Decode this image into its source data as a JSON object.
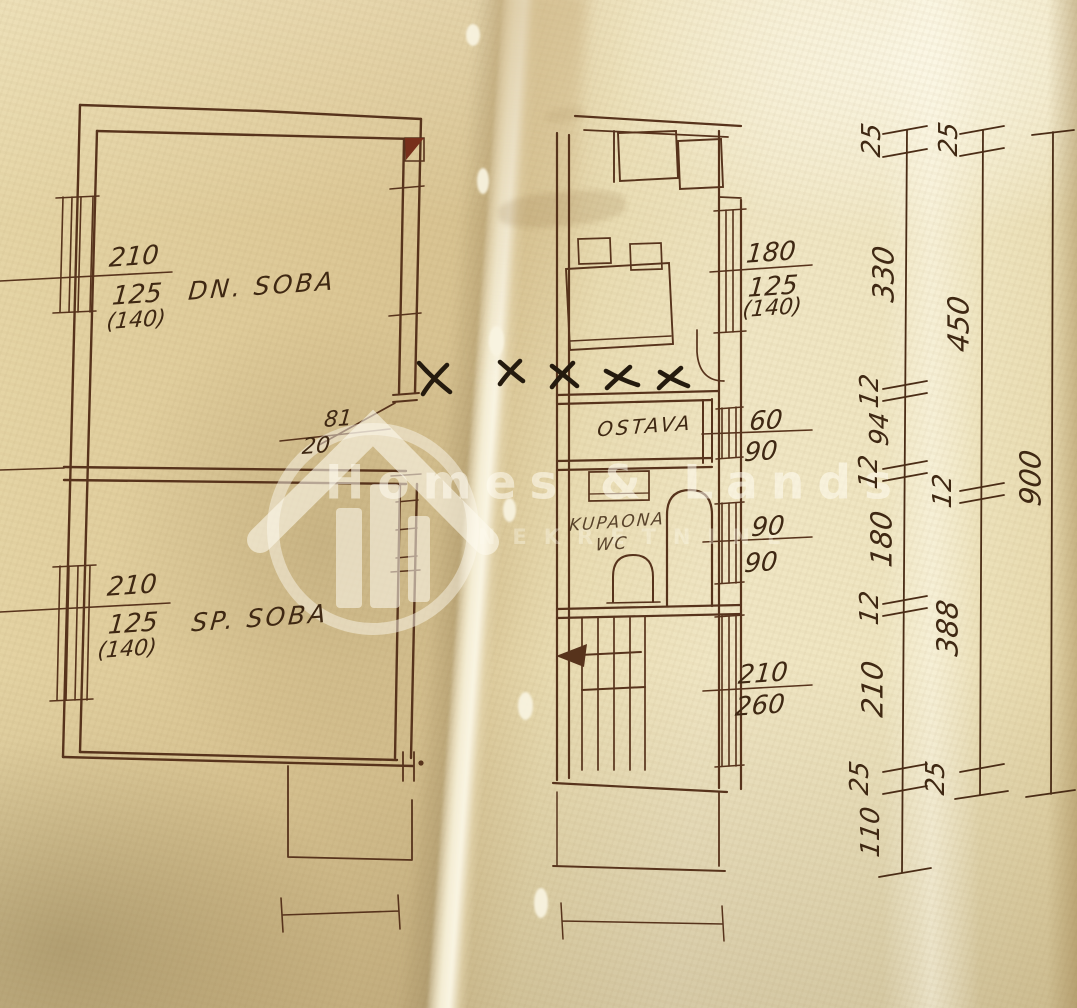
{
  "watermark": {
    "brand": "Homes & Lands",
    "tagline": "NEKRETNINE"
  },
  "rooms": {
    "living": "DN. SOBA",
    "bedroom": "SP. SOBA",
    "pantry": "OSTAVA",
    "bath_line1": "KUPAONA",
    "bath_line2": "WC"
  },
  "openings": {
    "living_window": {
      "w": "210",
      "h": "125",
      "alt": "(140)"
    },
    "bedroom_window": {
      "w": "210",
      "h": "125",
      "alt": "(140)"
    },
    "kitchen_window": {
      "w": "180",
      "h": "125",
      "alt": "(140)"
    },
    "living_door": {
      "w": "81",
      "h": "20"
    },
    "pantry_door": {
      "w": "60",
      "h": "90"
    },
    "bath_window": {
      "w": "90",
      "h": "90"
    },
    "stair_window": {
      "w": "210",
      "h": "260"
    }
  },
  "dimension_chains": {
    "inner": [
      "25",
      "330",
      "12",
      "94",
      "12",
      "180",
      "12",
      "210",
      "25",
      "110"
    ],
    "middle": [
      "25",
      "450",
      "12",
      "388",
      "25"
    ],
    "outer": [
      "900"
    ]
  },
  "colors": {
    "ink": "#57331c",
    "handwriting": "#3f2813",
    "annotation_x": "#241a0e",
    "chimney_fill": "#772f1b",
    "paper_left": "#dcc795",
    "paper_right": "#f0e6c4"
  }
}
